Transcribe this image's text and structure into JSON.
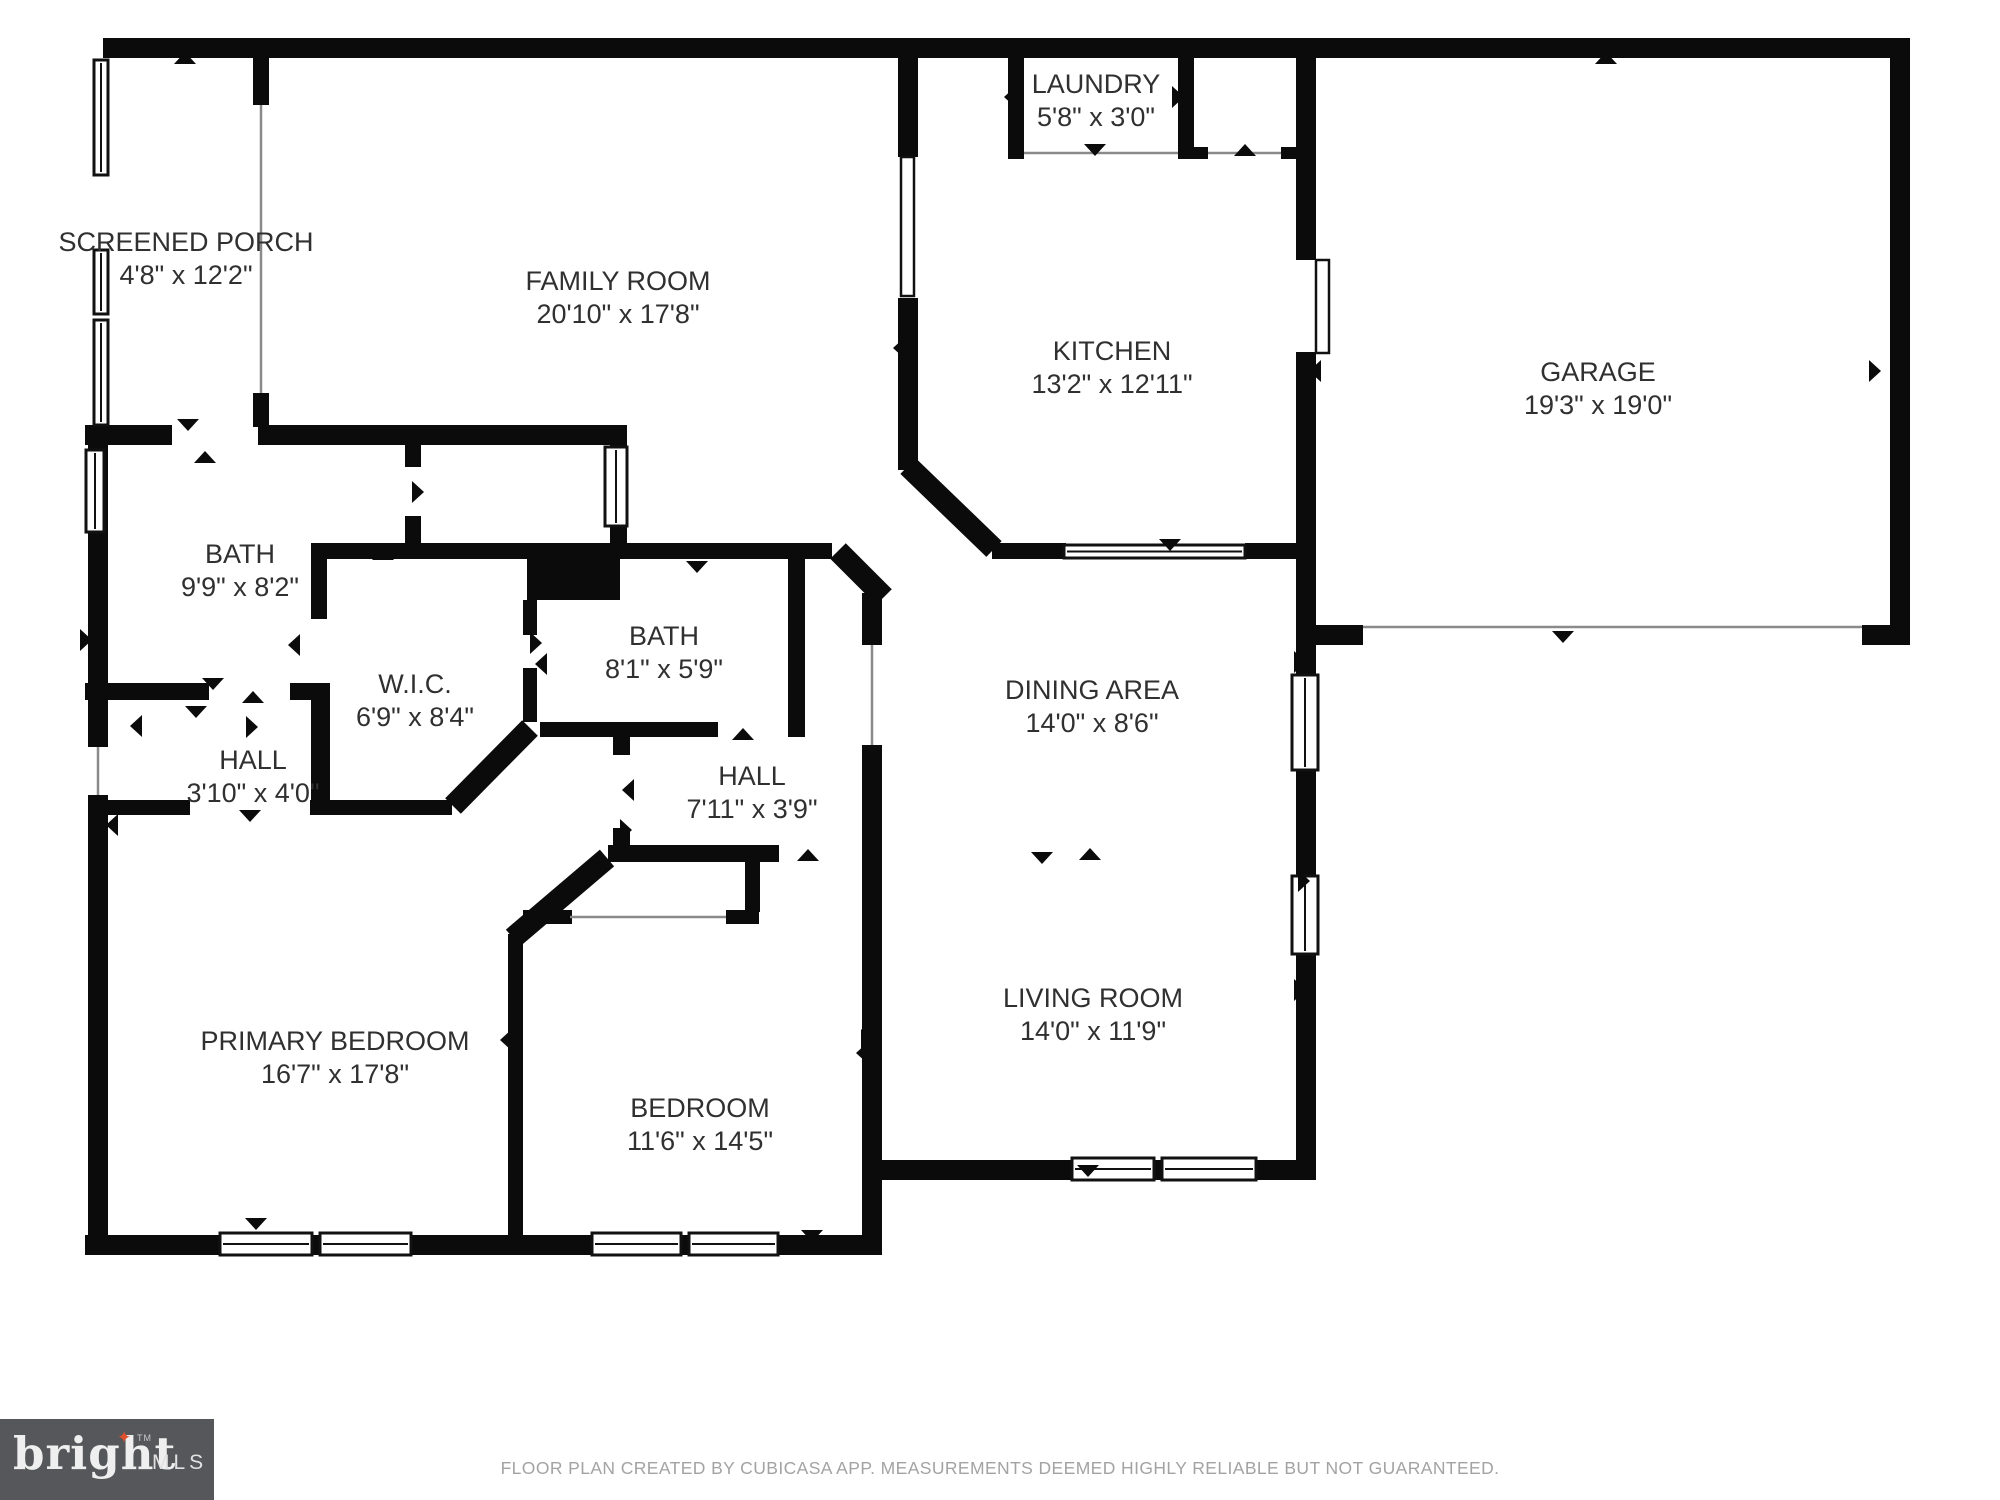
{
  "footer": {
    "text": "FLOOR PLAN CREATED BY CUBICASA APP. MEASUREMENTS DEEMED HIGHLY RELIABLE BUT NOT GUARANTEED."
  },
  "logo": {
    "brand": "bright",
    "suffix": "MLS",
    "tm": "TM",
    "star_icon": "four-point-star",
    "bg_color": "#56575b",
    "star_color": "#e0502a"
  },
  "plan": {
    "colors": {
      "wall": "#0b0b0b",
      "text": "#303030",
      "thin_line": "#8a8a8a",
      "window_stroke": "#111111"
    },
    "rooms": [
      {
        "label": "SCREENED PORCH",
        "dims": "4'8\" x 12'2\"",
        "cx": 186,
        "cy": 244
      },
      {
        "label": "FAMILY ROOM",
        "dims": "20'10\" x 17'8\"",
        "cx": 618,
        "cy": 283
      },
      {
        "label": "LAUNDRY",
        "dims": "5'8\" x 3'0\"",
        "cx": 1096,
        "cy": 86
      },
      {
        "label": "KITCHEN",
        "dims": "13'2\" x 12'11\"",
        "cx": 1112,
        "cy": 353
      },
      {
        "label": "GARAGE",
        "dims": "19'3\" x 19'0\"",
        "cx": 1598,
        "cy": 374
      },
      {
        "label": "BATH",
        "dims": "9'9\" x 8'2\"",
        "cx": 240,
        "cy": 556
      },
      {
        "label": "W.I.C.",
        "dims": "6'9\" x 8'4\"",
        "cx": 415,
        "cy": 686
      },
      {
        "label": "BATH",
        "dims": "8'1\" x 5'9\"",
        "cx": 664,
        "cy": 638
      },
      {
        "label": "HALL",
        "dims": "3'10\" x 4'0\"",
        "cx": 253,
        "cy": 762
      },
      {
        "label": "HALL",
        "dims": "7'11\" x 3'9\"",
        "cx": 752,
        "cy": 778
      },
      {
        "label": "DINING AREA",
        "dims": "14'0\" x 8'6\"",
        "cx": 1092,
        "cy": 692
      },
      {
        "label": "PRIMARY BEDROOM",
        "dims": "16'7\" x 17'8\"",
        "cx": 335,
        "cy": 1043
      },
      {
        "label": "BEDROOM",
        "dims": "11'6\" x 14'5\"",
        "cx": 700,
        "cy": 1110
      },
      {
        "label": "LIVING ROOM",
        "dims": "14'0\" x 11'9\"",
        "cx": 1093,
        "cy": 1000
      }
    ],
    "walls": [
      [
        103,
        38,
        1807,
        20
      ],
      [
        1890,
        38,
        20,
        607
      ],
      [
        1862,
        625,
        48,
        20
      ],
      [
        1315,
        625,
        48,
        20
      ],
      [
        1296,
        58,
        20,
        202
      ],
      [
        1296,
        352,
        20,
        325
      ],
      [
        1296,
        768,
        20,
        110
      ],
      [
        1296,
        952,
        20,
        228
      ],
      [
        882,
        1160,
        192,
        20
      ],
      [
        1256,
        1160,
        60,
        20
      ],
      [
        1154,
        1160,
        8,
        20
      ],
      [
        85,
        1235,
        137,
        20
      ],
      [
        312,
        1235,
        8,
        20
      ],
      [
        411,
        1235,
        181,
        20
      ],
      [
        681,
        1235,
        8,
        20
      ],
      [
        778,
        1235,
        104,
        20
      ],
      [
        88,
        425,
        20,
        322
      ],
      [
        88,
        795,
        20,
        460
      ],
      [
        253,
        58,
        16,
        47
      ],
      [
        253,
        393,
        16,
        34
      ],
      [
        85,
        425,
        87,
        20
      ],
      [
        258,
        425,
        369,
        20
      ],
      [
        405,
        442,
        16,
        25
      ],
      [
        405,
        516,
        16,
        41
      ],
      [
        610,
        437,
        17,
        14
      ],
      [
        610,
        524,
        17,
        22
      ],
      [
        311,
        543,
        521,
        16
      ],
      [
        527,
        559,
        93,
        41
      ],
      [
        311,
        559,
        16,
        60
      ],
      [
        311,
        686,
        19,
        116
      ],
      [
        523,
        600,
        14,
        35
      ],
      [
        523,
        668,
        14,
        54
      ],
      [
        540,
        722,
        94,
        15
      ],
      [
        634,
        722,
        84,
        15
      ],
      [
        788,
        722,
        17,
        15
      ],
      [
        788,
        557,
        17,
        167
      ],
      [
        862,
        593,
        20,
        52
      ],
      [
        862,
        745,
        20,
        510
      ],
      [
        898,
        58,
        20,
        99
      ],
      [
        898,
        298,
        20,
        172
      ],
      [
        1008,
        58,
        16,
        89
      ],
      [
        1178,
        58,
        16,
        89
      ],
      [
        1008,
        147,
        16,
        12
      ],
      [
        1178,
        147,
        16,
        12
      ],
      [
        1193,
        147,
        15,
        12
      ],
      [
        1281,
        147,
        15,
        12
      ],
      [
        992,
        543,
        74,
        16
      ],
      [
        1245,
        543,
        51,
        16
      ],
      [
        608,
        845,
        171,
        17
      ],
      [
        613,
        737,
        17,
        18
      ],
      [
        613,
        828,
        17,
        19
      ],
      [
        745,
        862,
        15,
        50
      ],
      [
        726,
        910,
        33,
        14
      ],
      [
        523,
        910,
        49,
        14
      ],
      [
        85,
        683,
        124,
        17
      ],
      [
        290,
        683,
        40,
        17
      ],
      [
        108,
        800,
        82,
        15
      ],
      [
        310,
        800,
        142,
        15
      ],
      [
        508,
        934,
        15,
        301
      ]
    ],
    "diagonals": [
      [
        838,
        551,
        884,
        597
      ],
      [
        908,
        466,
        994,
        549
      ],
      [
        530,
        728,
        453,
        806
      ],
      [
        607,
        858,
        513,
        938
      ]
    ],
    "windows": [
      [
        94,
        60,
        14,
        115,
        "v"
      ],
      [
        94,
        250,
        14,
        64,
        "v"
      ],
      [
        94,
        320,
        14,
        105,
        "v"
      ],
      [
        86,
        450,
        18,
        82,
        "v"
      ],
      [
        605,
        447,
        22,
        79,
        "v"
      ],
      [
        1064,
        545,
        181,
        13,
        "h"
      ],
      [
        1292,
        675,
        26,
        95,
        "v"
      ],
      [
        1292,
        876,
        26,
        78,
        "v"
      ],
      [
        1072,
        1158,
        82,
        22,
        "h"
      ],
      [
        1162,
        1158,
        94,
        22,
        "h"
      ],
      [
        220,
        1233,
        92,
        22,
        "h"
      ],
      [
        320,
        1233,
        91,
        22,
        "h"
      ],
      [
        592,
        1233,
        89,
        22,
        "h"
      ],
      [
        689,
        1233,
        89,
        22,
        "h"
      ]
    ],
    "door_leaves": [
      [
        901,
        157,
        13,
        139
      ],
      [
        1316,
        260,
        13,
        93
      ]
    ],
    "thin_lines": [
      [
        261,
        105,
        261,
        393
      ],
      [
        872,
        645,
        872,
        745
      ],
      [
        1024,
        153,
        1178,
        153
      ],
      [
        1208,
        153,
        1281,
        153
      ],
      [
        570,
        917,
        726,
        917
      ],
      [
        1363,
        627,
        1862,
        627
      ],
      [
        98,
        747,
        98,
        795
      ]
    ],
    "arrows": [
      [
        205,
        463,
        "u"
      ],
      [
        188,
        419,
        "d"
      ],
      [
        185,
        64,
        "u"
      ],
      [
        412,
        492,
        "r"
      ],
      [
        383,
        560,
        "u"
      ],
      [
        300,
        645,
        "l"
      ],
      [
        530,
        643,
        "r"
      ],
      [
        547,
        664,
        "l"
      ],
      [
        213,
        678,
        "d"
      ],
      [
        253,
        703,
        "u"
      ],
      [
        80,
        640,
        "r"
      ],
      [
        142,
        726,
        "l"
      ],
      [
        246,
        727,
        "r"
      ],
      [
        196,
        706,
        "d"
      ],
      [
        250,
        810,
        "d"
      ],
      [
        118,
        825,
        "l"
      ],
      [
        634,
        790,
        "l"
      ],
      [
        620,
        830,
        "r"
      ],
      [
        743,
        740,
        "u"
      ],
      [
        697,
        561,
        "d"
      ],
      [
        750,
        847,
        "d"
      ],
      [
        808,
        861,
        "u"
      ],
      [
        864,
        792,
        "r"
      ],
      [
        880,
        990,
        "l"
      ],
      [
        868,
        1053,
        "l"
      ],
      [
        1088,
        1165,
        "d"
      ],
      [
        1294,
        990,
        "r"
      ],
      [
        1042,
        852,
        "d"
      ],
      [
        1090,
        860,
        "u"
      ],
      [
        1294,
        662,
        "r"
      ],
      [
        1298,
        881,
        "r"
      ],
      [
        1170,
        539,
        "d"
      ],
      [
        905,
        348,
        "l"
      ],
      [
        1016,
        97,
        "l"
      ],
      [
        1172,
        97,
        "r"
      ],
      [
        1095,
        144,
        "d"
      ],
      [
        1245,
        156,
        "u"
      ],
      [
        1606,
        64,
        "u"
      ],
      [
        1563,
        631,
        "d"
      ],
      [
        1321,
        371,
        "l"
      ],
      [
        1869,
        371,
        "r"
      ],
      [
        812,
        1230,
        "d"
      ],
      [
        256,
        1218,
        "d"
      ],
      [
        512,
        1040,
        "l"
      ],
      [
        861,
        1040,
        "r"
      ]
    ]
  }
}
